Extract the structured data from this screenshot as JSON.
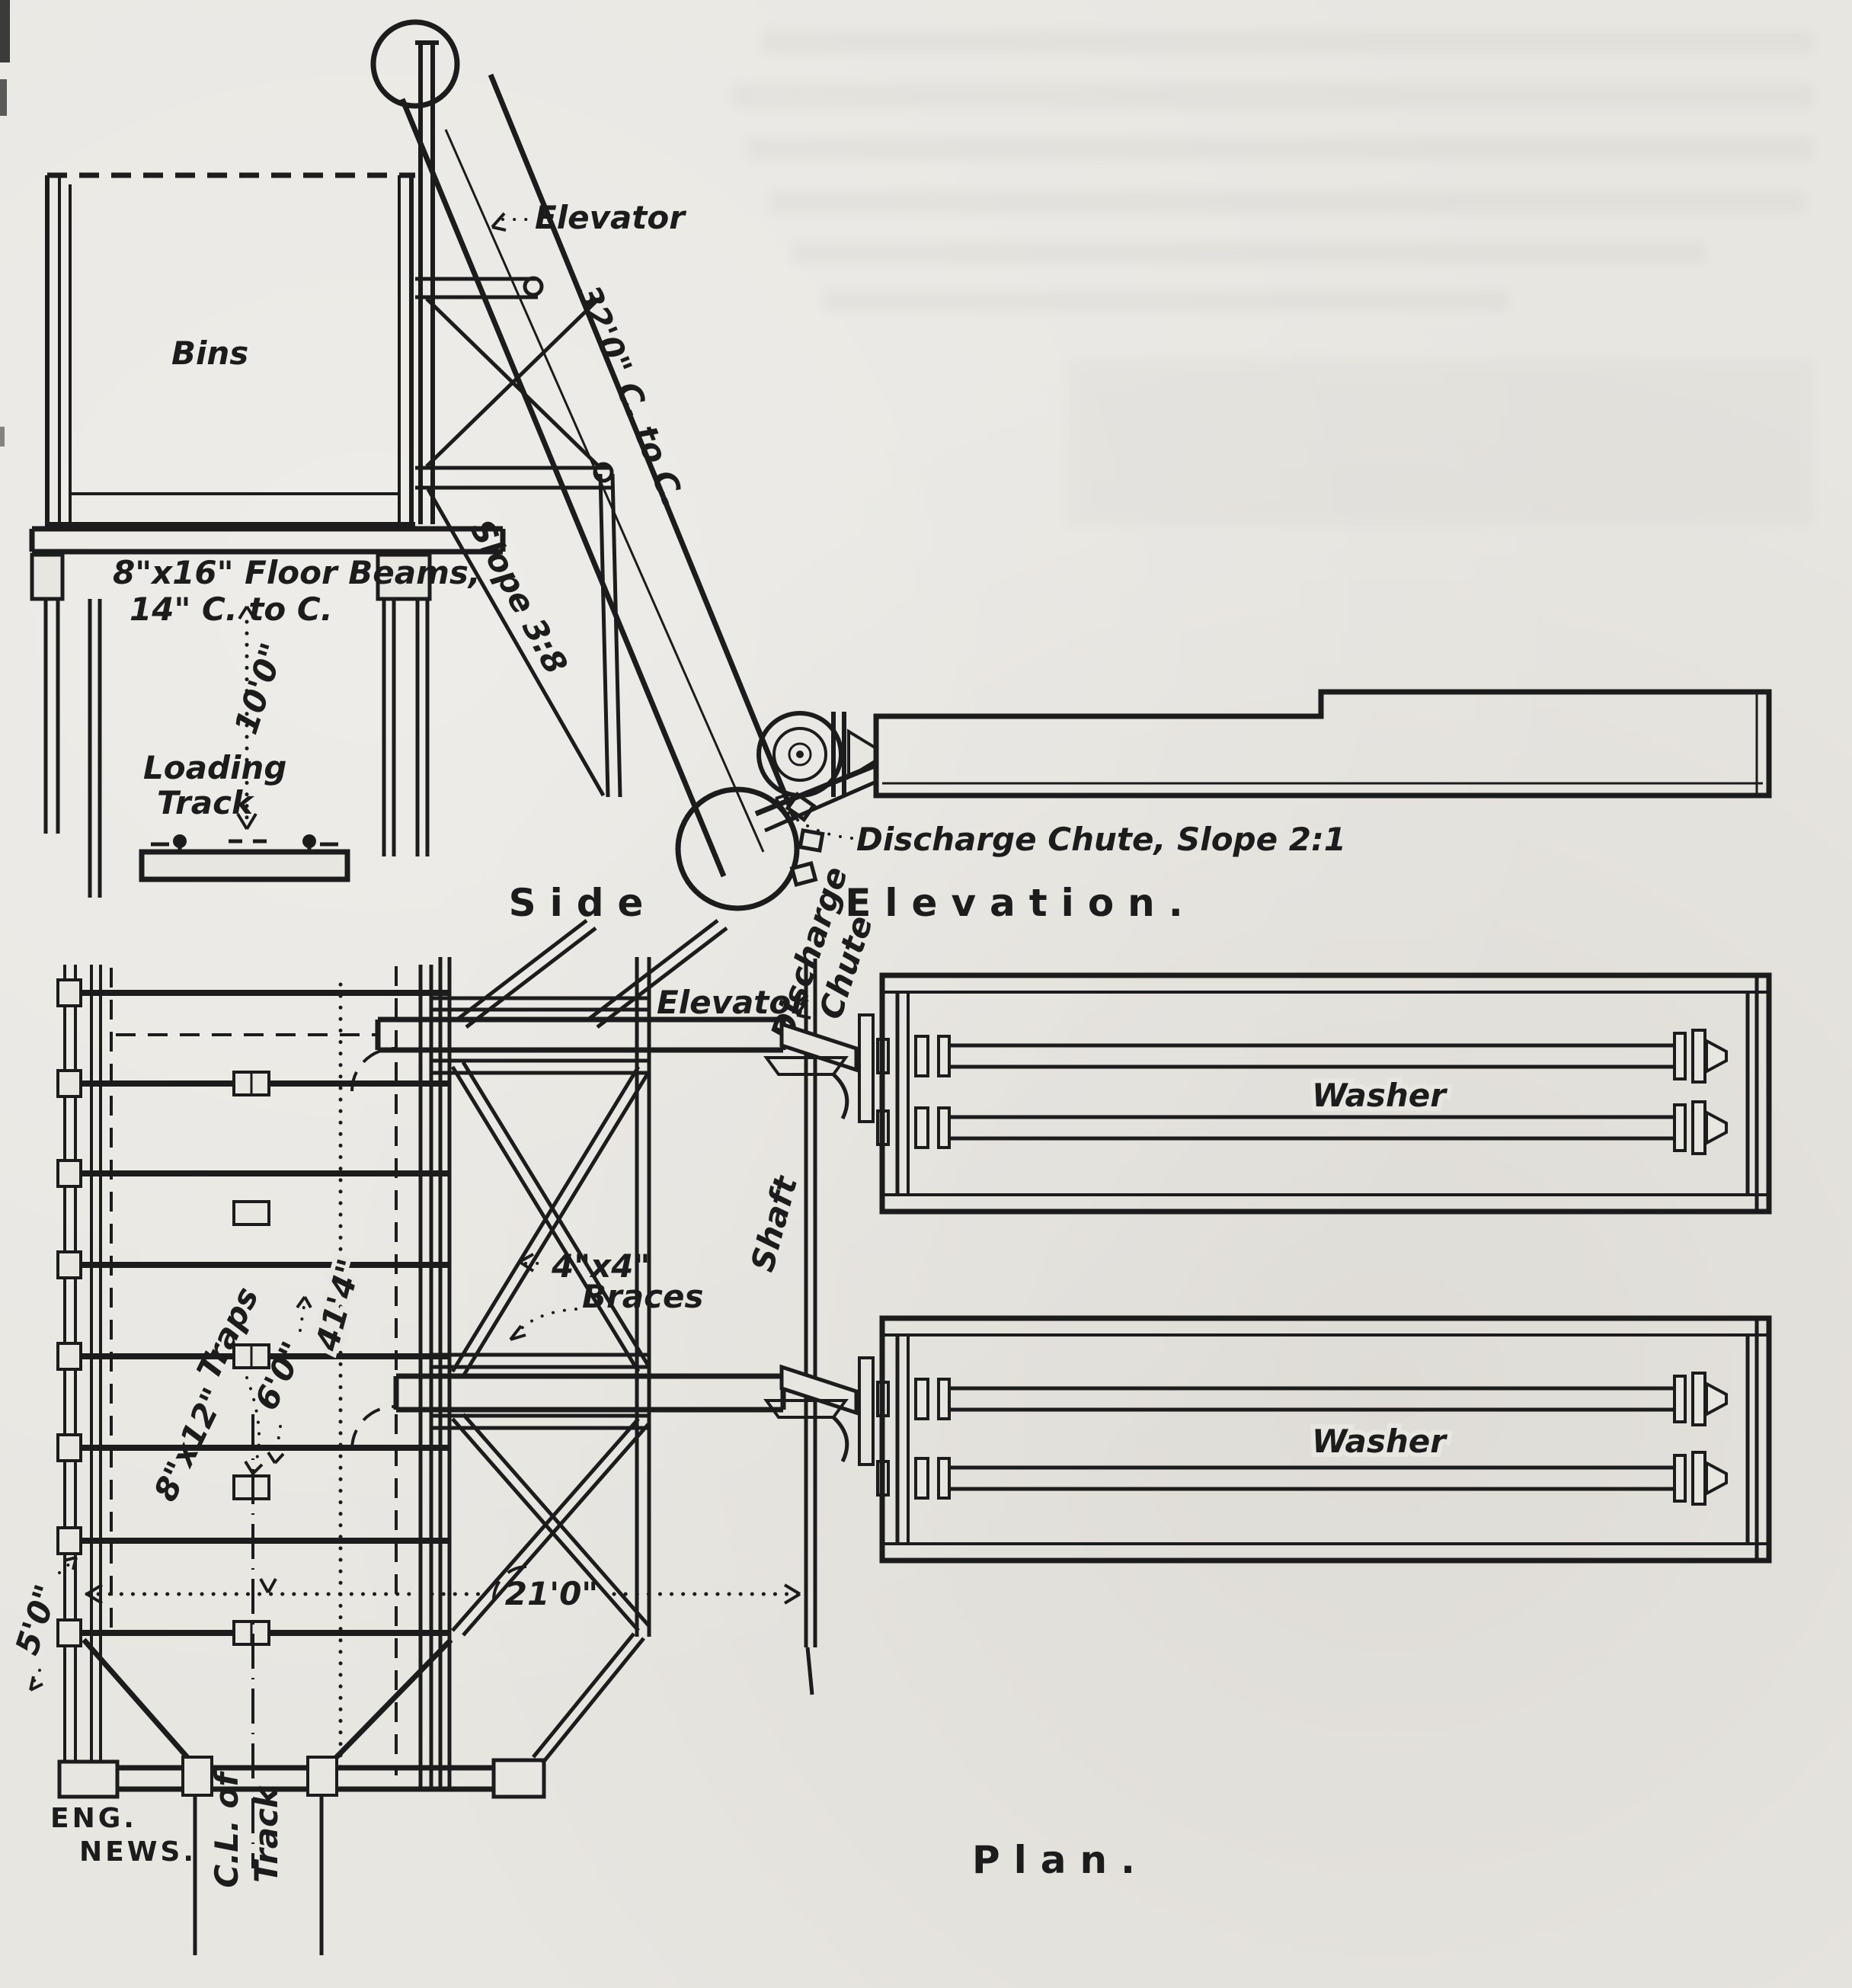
{
  "figure": {
    "paper_color": "#e8e6e1",
    "ink_color": "#1c1c1c",
    "source_credit": {
      "line1": "ENG.",
      "line2": "NEWS."
    },
    "side_elevation": {
      "caption": {
        "word1": "Side",
        "word2": "Elevation."
      },
      "bins_label": "Bins",
      "elevator_label": "Elevator",
      "elevator_length_dim": "32'0\" C. to C.",
      "elevator_slope": "Slope 3:8",
      "floor_beams_note": {
        "line1": "8\"x16\" Floor Beams,",
        "line2": "14\" C. to C."
      },
      "clearance_dim": "10'0\"",
      "loading_track_label": {
        "line1": "Loading",
        "line2": "Track"
      },
      "discharge_chute_note": "Discharge Chute, Slope 2:1"
    },
    "plan": {
      "caption": "Plan.",
      "elevator_label": "Elevator",
      "discharge_chute_label": {
        "line1": "Discharge",
        "line2": "Chute"
      },
      "shaft_label": "Shaft",
      "braces_note": {
        "line1": "4\"x4\"",
        "line2": "Braces"
      },
      "washer_upper_label": "Washer",
      "washer_lower_label": "Washer",
      "traps_note": {
        "line1": "8\"x12\"",
        "line2": "Traps"
      },
      "bin_length_dim": "41'4\"",
      "trap_spacing_dim": "6'0\"",
      "track_gauge_dim": "5'0\"",
      "shaft_offset_dim": "21'0\"",
      "track_centerline_label": {
        "line1": "C.L. of",
        "line2": "Track"
      }
    }
  }
}
